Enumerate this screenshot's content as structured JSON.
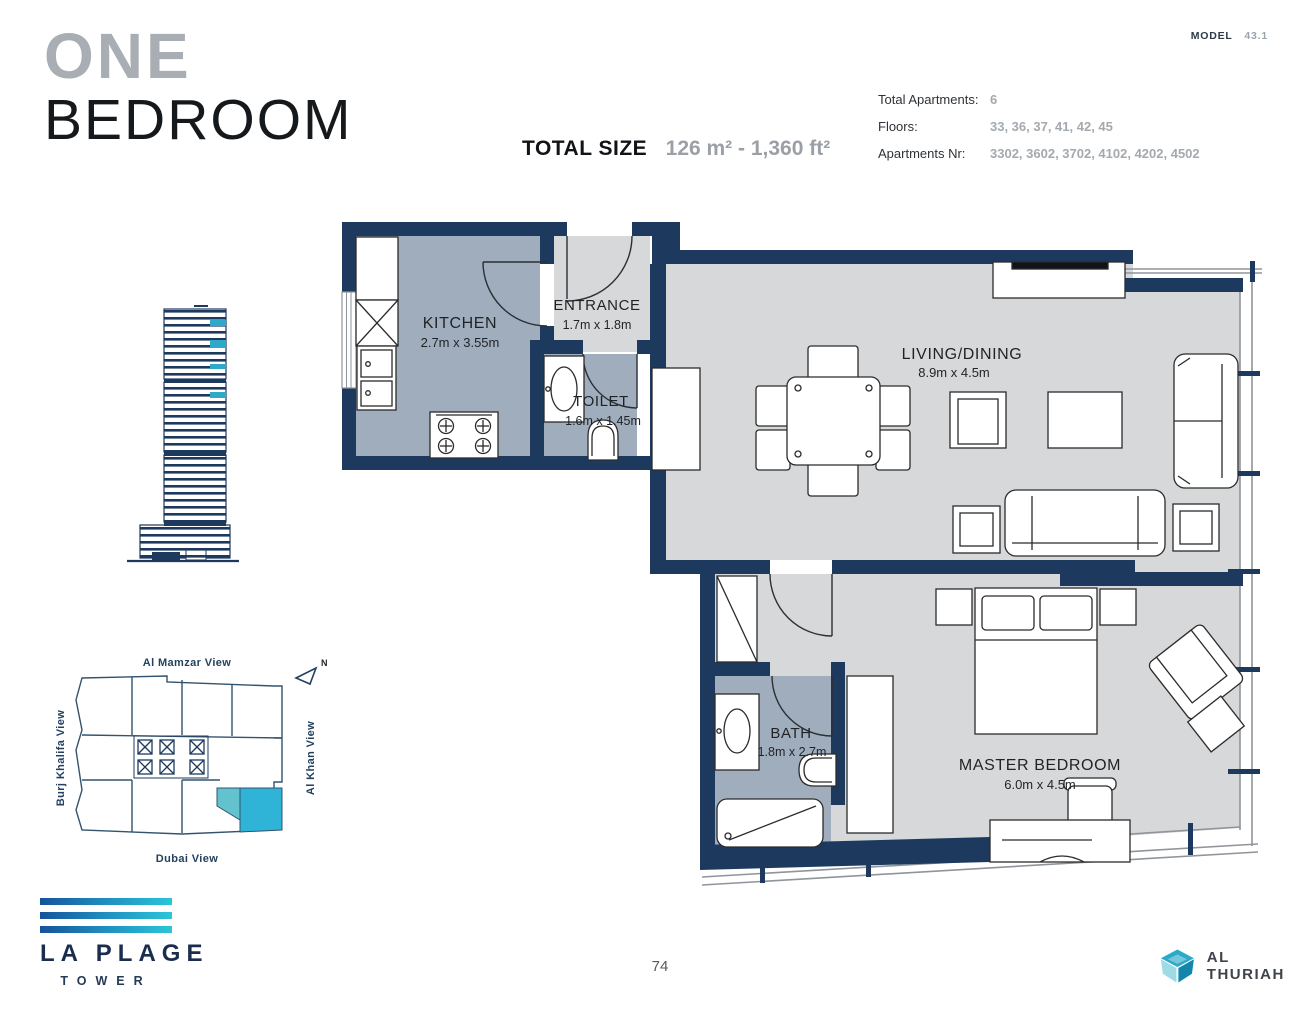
{
  "header": {
    "title": {
      "line1": "ONE",
      "line2": "BEDROOM"
    },
    "total_size": {
      "label": "TOTAL SIZE",
      "value": "126 m² - 1,360 ft²"
    },
    "model": {
      "label": "MODEL",
      "value": "43.1"
    },
    "info": [
      {
        "label": "Total Apartments:",
        "value": "6"
      },
      {
        "label": "Floors:",
        "value": "33, 36, 37, 41, 42, 45"
      },
      {
        "label": "Apartments Nr:",
        "value": "3302, 3602, 3702, 4102, 4202, 4502"
      }
    ]
  },
  "plan": {
    "rooms": [
      {
        "name": "KITCHEN",
        "dims": "2.7m x 3.55m"
      },
      {
        "name": "ENTRANCE",
        "dims": "1.7m x 1.8m"
      },
      {
        "name": "TOILET",
        "dims": "1.6m x 1.45m"
      },
      {
        "name": "LIVING/DINING",
        "dims": "8.9m x 4.5m"
      },
      {
        "name": "BATH",
        "dims": "1.8m x 2.7m"
      },
      {
        "name": "MASTER BEDROOM",
        "dims": "6.0m x 4.5m"
      }
    ]
  },
  "site_plan": {
    "top": "Al Mamzar View",
    "left": "Burj Khalifa View",
    "right": "Al Khan View",
    "bottom": "Dubai View",
    "north": "N"
  },
  "footer": {
    "page": "74",
    "brand": {
      "line1": "LA PLAGE",
      "line2": "TOWER"
    },
    "developer": "AL THURIAH"
  },
  "colors": {
    "wall": "#1d3a5e",
    "wet_floor": "#9fadbd",
    "dry_floor": "#d7d8da",
    "accent_teal": "#2fb3d6",
    "highlight_unit": "#35b6d9"
  }
}
